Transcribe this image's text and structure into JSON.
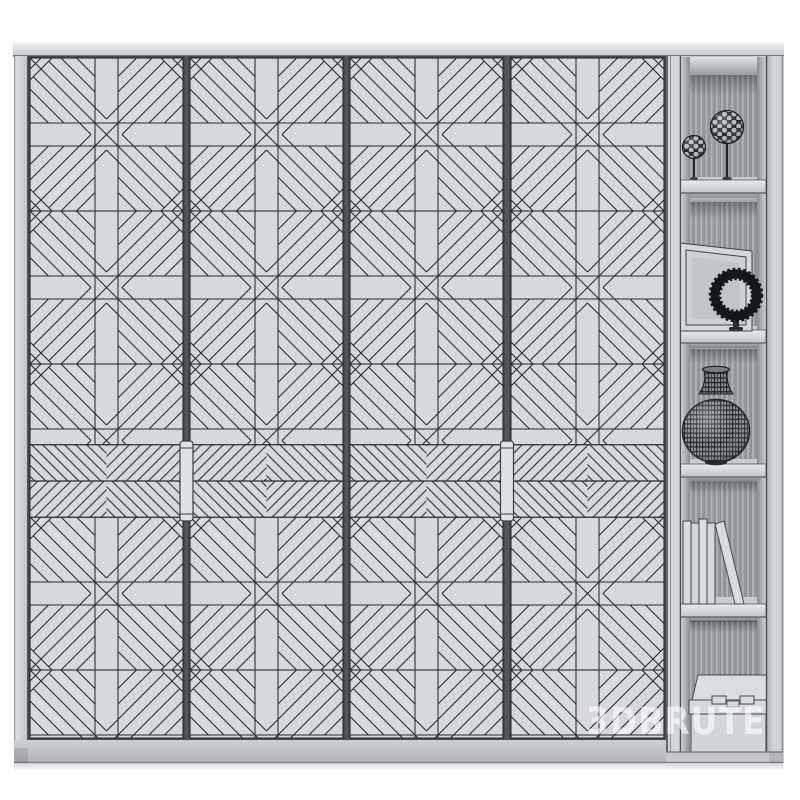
{
  "watermark": {
    "text": "3DBRUTE"
  },
  "scene": {
    "furniture": {
      "type_label": "wardrobe-with-side-shelves",
      "door_count": 4,
      "door_pattern": "woven-geometric-parquet-tiles",
      "middle_band_pattern": "herringbone-chevron",
      "handle_count": 2
    },
    "shelf_items": [
      {
        "label": "two-openwork-decor-spheres-on-stands"
      },
      {
        "label": "leaning-picture-frame-with-black-beaded-ring"
      },
      {
        "label": "round-woven-vase"
      },
      {
        "label": "row-of-books-one-leaning"
      },
      {
        "label": "storage-box-with-lid-and-clasps"
      }
    ]
  },
  "colors": {
    "background": "#ffffff",
    "cabinet_light": "#d6d8db",
    "cabinet_mid": "#cfd1d4",
    "line_dark": "#26292e",
    "frame_gray": "#45484d",
    "interior_wall": "#c7c9cc",
    "item_dark": "#1b1d20",
    "watermark": "rgba(255,255,255,0.60)"
  }
}
